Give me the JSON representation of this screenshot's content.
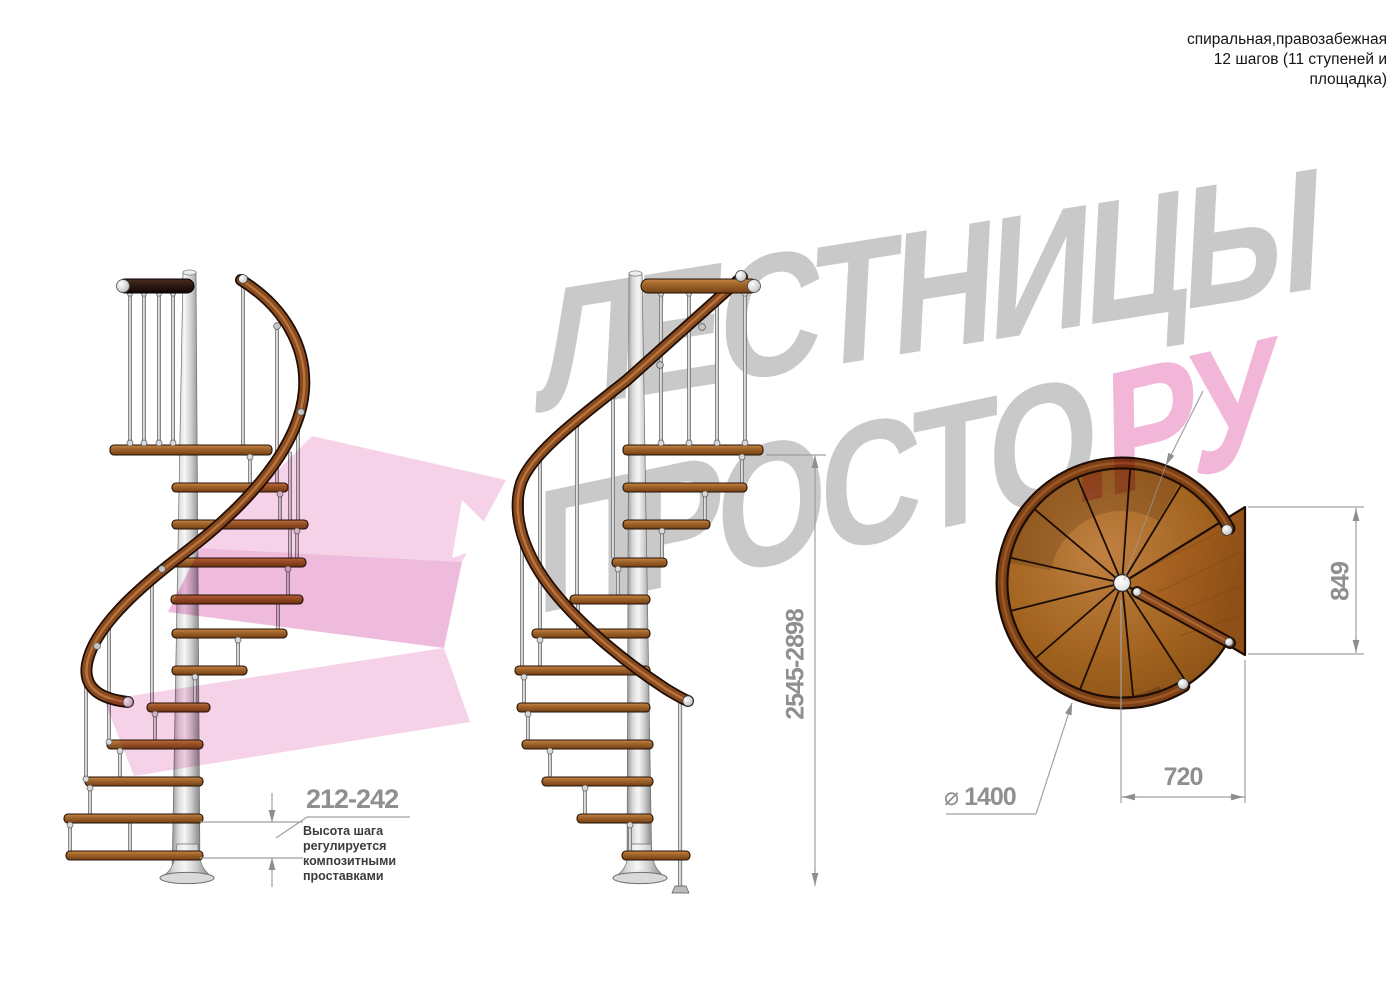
{
  "header": {
    "line1": "спиральная,правозабежная",
    "line2": "12 шагов (11 ступеней и",
    "line3": "площадка)"
  },
  "watermark": {
    "word1": "ЛЕСТНИЦЫ",
    "word2": "ПРОСТО",
    "word3": ".РУ",
    "gray": "#c9c9c9",
    "pink": "#f2b6d8"
  },
  "dimensions": {
    "step_height": "212-242",
    "step_height_note": [
      "Высота шага",
      "регулируется",
      "композитными",
      "проставками"
    ],
    "total_height": "2545-2898",
    "landing_depth": "849",
    "landing_width": "720",
    "diameter_symbol": "⌀",
    "diameter_value": "1400"
  },
  "colors": {
    "wood": "#a4682c",
    "wood_dark": "#744015",
    "metal": "#d8d8d8",
    "dimension_gray": "#8f8f8f",
    "note_text": "#3b3b3b"
  }
}
